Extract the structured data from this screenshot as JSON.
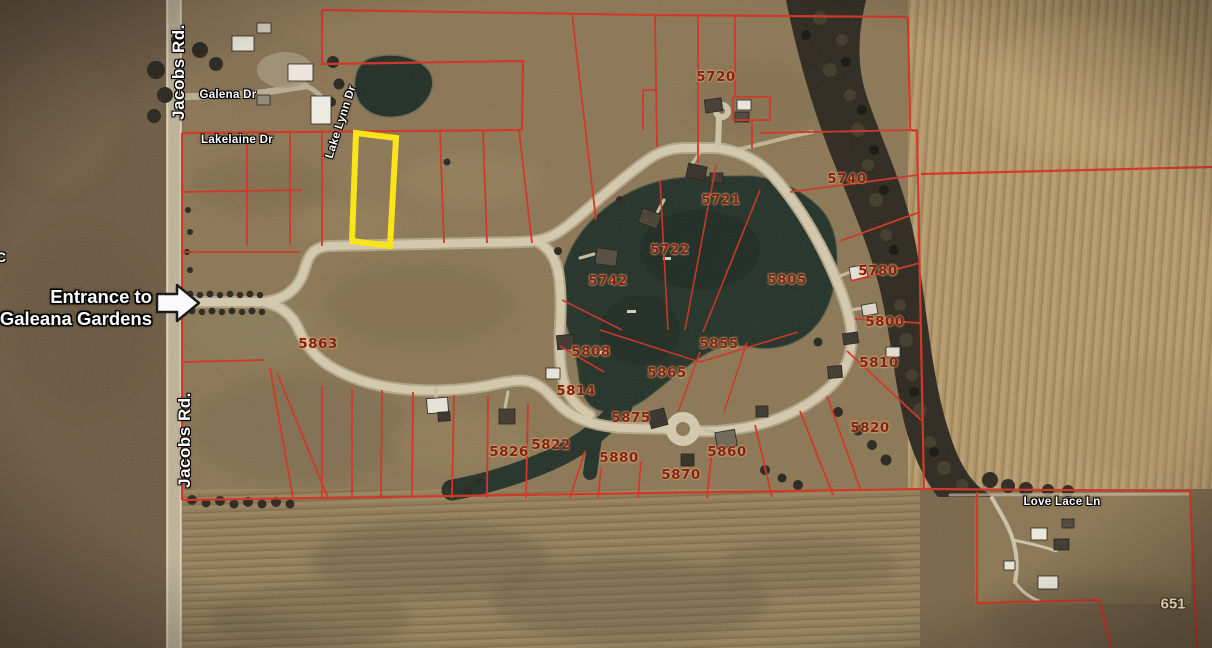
{
  "map": {
    "highlight_color": "#ffe70d",
    "boundary_color": "#d2301e",
    "streets": {
      "jacobs_top": "Jacobs Rd.",
      "jacobs_bottom": "Jacobs Rd.",
      "galena": "Galena Dr",
      "lakelaine": "Lakelaine Dr",
      "lake_lynn": "Lake Lynn Dr",
      "love_lace": "Love Lace Ln"
    },
    "entrance_note": {
      "line1": "Entrance to",
      "line2": "Galeana Gardens"
    },
    "edge_label": "C",
    "parcel_right": "651",
    "lots": [
      {
        "id": "5720",
        "x": 716,
        "y": 77
      },
      {
        "id": "5721",
        "x": 721,
        "y": 200
      },
      {
        "id": "5722",
        "x": 670,
        "y": 250
      },
      {
        "id": "5740",
        "x": 847,
        "y": 179
      },
      {
        "id": "5742",
        "x": 608,
        "y": 281
      },
      {
        "id": "5805",
        "x": 787,
        "y": 280
      },
      {
        "id": "5780",
        "x": 878,
        "y": 271
      },
      {
        "id": "5800",
        "x": 885,
        "y": 322
      },
      {
        "id": "5810",
        "x": 879,
        "y": 363
      },
      {
        "id": "5820",
        "x": 870,
        "y": 428
      },
      {
        "id": "5808",
        "x": 591,
        "y": 352
      },
      {
        "id": "5855",
        "x": 719,
        "y": 344
      },
      {
        "id": "5865",
        "x": 667,
        "y": 373
      },
      {
        "id": "5814",
        "x": 576,
        "y": 391
      },
      {
        "id": "5875",
        "x": 631,
        "y": 418
      },
      {
        "id": "5822",
        "x": 551,
        "y": 445
      },
      {
        "id": "5826",
        "x": 509,
        "y": 452
      },
      {
        "id": "5880",
        "x": 619,
        "y": 458
      },
      {
        "id": "5860",
        "x": 727,
        "y": 452
      },
      {
        "id": "5870",
        "x": 681,
        "y": 475
      },
      {
        "id": "5863",
        "x": 318,
        "y": 344
      }
    ]
  }
}
